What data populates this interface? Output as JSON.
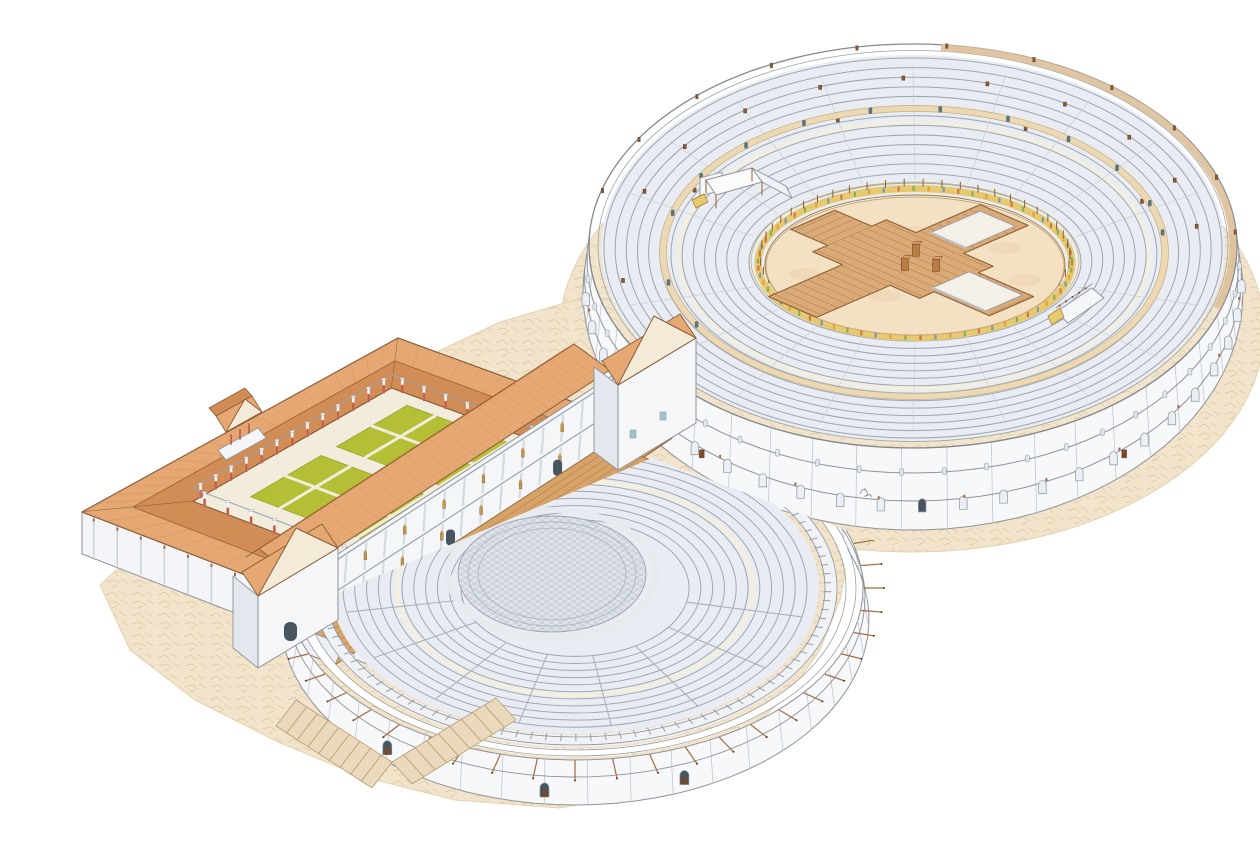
{
  "palette": {
    "bg": "#ffffff",
    "groundFill": "#f2e4cb",
    "groundCrack": "#dcc5a2",
    "groundEdge": "#e6d2b2",
    "wallWhite": "#f7f8fa",
    "wallShade": "#e2e8ee",
    "wallLine": "#8e9299",
    "jointLine": "#b9c2cb",
    "seatFill": "#e9edf3",
    "seatLine": "#9da8b4",
    "seatWalk": "#f3eee2",
    "cunei": "#c3cbd3",
    "rimTan": "#dcbf97",
    "balteus": "#ecd9b4",
    "balteusEdge": "#c4ad83",
    "doorDark": "#5a7482",
    "podiumGold": "#e7c96f",
    "podiumEdge": "#a5762e",
    "podiumOuter": "#c9b06a",
    "arenaSand": "#f4e1c4",
    "sandEdge": "#caa87b",
    "sandSpot": "#e9d2ae",
    "wood": "#d9a976",
    "woodLine": "#b9854f",
    "woodEdge": "#8a5f35",
    "stageWood": "#d7a369",
    "stageEdge": "#9c6b3b",
    "pit": "#f4f0e7",
    "pitLine": "#9aa0a8",
    "pitShade": "#b9bfc7",
    "brown": "#8a5a33",
    "brownDark": "#5f3a1e",
    "mast": "#a06a3e",
    "roofLight": "#e5a873",
    "roofMid": "#df9f68",
    "roofDark": "#d18c55",
    "roofLine": "#8a5c38",
    "roofTile": "#c98f59",
    "ridge": "#a5693c",
    "green": "#b5bf35",
    "greenLine": "#99a42b",
    "court": "#f2ecdc",
    "courtLine": "#cbbf9f",
    "orch": "#ccd3dd",
    "orchTile": "#dfe3e9",
    "orchDark": "#aab2be",
    "colRed": "#c2604c",
    "colWhite": "#f5f6f8",
    "colCap": "#e9ecf0",
    "statueGold": "#c49a52",
    "statueLine": "#7d5a26",
    "archDark": "#46555f",
    "doorBrown": "#7a4a28",
    "rampTan": "#ead9bd",
    "rampLine": "#c2a477",
    "rampEdge": "#b99d72",
    "towerWin": "#9fc3c9",
    "sig": "#8a8f96"
  },
  "scene": {
    "canvas": {
      "w": 1260,
      "h": 844
    },
    "ground": {
      "amphitheaterApron": {
        "cx": 912,
        "cy": 330,
        "rx": 352,
        "ry": 222
      },
      "theaterApron": [
        [
          100,
          585
        ],
        [
          170,
          520
        ],
        [
          240,
          468
        ],
        [
          330,
          418
        ],
        [
          420,
          360
        ],
        [
          500,
          322
        ],
        [
          575,
          300
        ],
        [
          655,
          298
        ],
        [
          702,
          324
        ],
        [
          668,
          364
        ],
        [
          700,
          404
        ],
        [
          762,
          444
        ],
        [
          822,
          494
        ],
        [
          848,
          560
        ],
        [
          840,
          600
        ],
        [
          820,
          650
        ],
        [
          792,
          690
        ],
        [
          736,
          744
        ],
        [
          660,
          790
        ],
        [
          560,
          808
        ],
        [
          455,
          800
        ],
        [
          360,
          776
        ],
        [
          278,
          742
        ],
        [
          195,
          700
        ],
        [
          130,
          650
        ]
      ]
    },
    "amphitheater": {
      "cx": 913,
      "cy": 246,
      "rx": 324,
      "ry": 202,
      "wall": {
        "drop": 46,
        "spreadX": 6,
        "spreadY": 36,
        "jointStep": 8,
        "upperWindowStep": 7.5,
        "lowerArchStep": 7.2,
        "doorAngles": [
          50,
          130
        ],
        "tickStep": 15
      },
      "rim": {
        "tanArc": [
          -85,
          18
        ],
        "mastAngles": [
          196,
          212,
          228,
          244,
          260,
          276,
          292,
          308,
          324,
          340,
          356
        ]
      },
      "bowl": {
        "rings": 14,
        "outer": [
          309,
          190
        ],
        "inner": [
          166,
          79
        ],
        "centerShift": [
          2,
          14
        ],
        "walkT": 0.52,
        "cuneiNear": [
          18,
          36,
          54,
          72,
          90,
          108,
          126,
          144,
          162
        ],
        "cuneiFar": [
          198,
          216,
          234,
          252,
          270,
          288,
          306,
          324,
          342
        ]
      },
      "balteus": {
        "cx": 914,
        "cy": 252.5,
        "rx": 251,
        "ry": 144,
        "doorAngles": [
          196,
          212,
          228,
          244,
          260,
          276,
          292,
          308,
          324,
          340,
          352,
          150,
          168
        ]
      },
      "brackets": [
        [
          0.16,
          200
        ],
        [
          0.16,
          217
        ],
        [
          0.16,
          234
        ],
        [
          0.16,
          251
        ],
        [
          0.16,
          268
        ],
        [
          0.16,
          285
        ],
        [
          0.16,
          302
        ],
        [
          0.16,
          319
        ],
        [
          0.16,
          336
        ],
        [
          0.16,
          352
        ],
        [
          0.44,
          207
        ],
        [
          0.44,
          252
        ],
        [
          0.44,
          297
        ],
        [
          0.44,
          338
        ],
        [
          0.1,
          152
        ],
        [
          0.1,
          170
        ]
      ],
      "podium": {
        "cx": 915,
        "cy": 263,
        "rx": 157,
        "ry": 74.5,
        "panelStep": 5.5,
        "postStep": 7,
        "panelColors": [
          "#cf6a45",
          "#7da854",
          "#df9f3c",
          "#6f94b5"
        ]
      },
      "arena": {
        "cx": 915,
        "cy": 266,
        "rx": 149,
        "ry": 69,
        "spots": [
          [
            -70,
            -10
          ],
          [
            40,
            22
          ],
          [
            90,
            -18
          ],
          [
            -30,
            30
          ],
          [
            0,
            -34
          ],
          [
            110,
            14
          ],
          [
            -110,
            8
          ]
        ]
      },
      "platform": {
        "m": [
          903,
          259
        ],
        "halfU": 58,
        "halfV": 40,
        "armU": 118,
        "armUneg": 98,
        "armVpos": 110,
        "armVneg": 120,
        "armHalfU": 26,
        "armHalfV": 24,
        "pits": [
          [
            52,
            -20,
            110,
            20
          ],
          [
            -18,
            48,
            20,
            102
          ]
        ],
        "boxes": [
          [
            8,
            -6
          ],
          [
            26,
            10
          ],
          [
            -4,
            18
          ]
        ]
      },
      "tribunal": {
        "canopy": [
          [
            706,
            180
          ],
          [
            752,
            168
          ],
          [
            762,
            182
          ],
          [
            716,
            195
          ]
        ],
        "wall": [
          [
            700,
            196
          ],
          [
            722,
            190
          ],
          [
            722,
            172
          ],
          [
            700,
            178
          ]
        ],
        "arch": [
          722,
          176,
          10,
          15
        ],
        "wing": [
          [
            752,
            168
          ],
          [
            786,
            186
          ],
          [
            792,
            198
          ],
          [
            762,
            182
          ]
        ],
        "gold": [
          [
            692,
            200
          ],
          [
            704,
            194
          ],
          [
            708,
            202
          ],
          [
            696,
            208
          ]
        ]
      },
      "ramp": {
        "floor": [
          [
            1056,
            312
          ],
          [
            1092,
            288
          ],
          [
            1104,
            298
          ],
          [
            1068,
            323
          ]
        ],
        "rail": [
          [
            1056,
            308
          ],
          [
            1092,
            284
          ]
        ],
        "gold": [
          [
            1048,
            316
          ],
          [
            1060,
            308
          ],
          [
            1064,
            317
          ],
          [
            1052,
            325
          ]
        ]
      }
    },
    "portico": {
      "corners": {
        "W": [
          82,
          512
        ],
        "N": [
          398,
          338
        ],
        "E": [
          672,
          438
        ],
        "S": [
          388,
          630
        ]
      },
      "courtyard": {
        "a0": 0.18,
        "a1": 0.82,
        "b0": 0.18,
        "b1": 0.8
      },
      "gardens": [
        {
          "a": [
            0.27,
            0.5
          ],
          "b": [
            0.28,
            0.48
          ]
        },
        {
          "a": [
            0.55,
            0.78
          ],
          "b": [
            0.28,
            0.48
          ]
        },
        {
          "a": [
            0.27,
            0.5
          ],
          "b": [
            0.54,
            0.74
          ]
        },
        {
          "a": [
            0.55,
            0.78
          ],
          "b": [
            0.54,
            0.74
          ]
        }
      ],
      "ornaments": {
        "statue": [
          0.52,
          0.51
        ],
        "figure": [
          0.42,
          0.55
        ],
        "bench": [
          0.47,
          0.58
        ]
      },
      "wallDrop": 42,
      "pilasters": 13,
      "ridgeF": 0.46,
      "colCounts": {
        "long": 13,
        "short": 8
      },
      "aedicula": {
        "base": [
          [
            218,
            450
          ],
          [
            258,
            428
          ],
          [
            266,
            438
          ],
          [
            226,
            460
          ]
        ],
        "ped": [
          [
            226,
            432
          ],
          [
            262,
            412
          ],
          [
            245,
            399
          ]
        ],
        "roofA": [
          [
            226,
            432
          ],
          [
            262,
            412
          ],
          [
            252,
            396
          ],
          [
            216,
            416
          ]
        ],
        "roofB": [
          [
            216,
            416
          ],
          [
            252,
            396
          ],
          [
            245,
            388
          ],
          [
            209,
            408
          ]
        ],
        "cols": [
          [
            231,
            444
          ],
          [
            240,
            439
          ],
          [
            249,
            433
          ]
        ]
      }
    },
    "theater": {
      "o": [
        575,
        588
      ],
      "k": 0.6,
      "clip": [
        [
          310,
          605
        ],
        [
          652,
          458
        ],
        [
          980,
          580
        ],
        [
          980,
          852
        ],
        [
          60,
          852
        ],
        [
          60,
          700
        ],
        [
          240,
          620
        ]
      ],
      "stage": {
        "f1": [
          335,
          665
        ],
        "f2": [
          650,
          460
        ],
        "depth": [
          -42,
          -17
        ],
        "teethStep": 0.068,
        "nLength": 5,
        "nTicks": 22
      },
      "frons": {
        "rise": [
          5,
          -68
        ],
        "cornices": [
          0.44,
          0.92
        ],
        "tiers": [
          [
            0.05,
            0.4
          ],
          [
            0.5,
            0.88
          ]
        ],
        "cols": 16,
        "doors": [
          0.16,
          0.5,
          0.84
        ]
      },
      "roof": {
        "eaveOff": [
          -3,
          -5
        ],
        "depthOff": [
          -36,
          -26
        ],
        "stripOff": [
          -13,
          8
        ],
        "tiles": 26
      },
      "wall": {
        "rx": 288,
        "ry": 172,
        "drop": 31,
        "spreadX": 6,
        "spreadY": 14,
        "jointStep": 8.5,
        "a0": -45,
        "a1": 198,
        "doorAngles": [
          68,
          96,
          130
        ],
        "mastStep": 7.5,
        "mastLen": 20
      },
      "parapet": {
        "rx": 276,
        "ry": 165
      },
      "gallery": {
        "rx": 256,
        "ry": 153,
        "colStep": 3.4,
        "a0": -70,
        "a1": 196
      },
      "seating": {
        "outer": [
          244,
          146
        ],
        "rings": 11,
        "r0": 232,
        "dr": 11.8,
        "walk": 178,
        "stairs": [
          12,
          35,
          58,
          81,
          104,
          127,
          150,
          170
        ],
        "inner": 114
      },
      "orchestra": {
        "c": [
          552,
          574
        ],
        "rx": 94,
        "ry": 58,
        "rings": [
          84,
          74
        ],
        "proedria": [
          104,
          64
        ]
      },
      "towerLeft": {
        "front": [
          [
            258,
            668
          ],
          [
            338,
            620
          ],
          [
            338,
            548
          ],
          [
            258,
            596
          ]
        ],
        "side": [
          [
            233,
            648
          ],
          [
            258,
            668
          ],
          [
            258,
            596
          ],
          [
            233,
            576
          ]
        ],
        "ped": [
          [
            258,
            596
          ],
          [
            338,
            548
          ],
          [
            296,
            528
          ]
        ],
        "roof": [
          [
            258,
            596
          ],
          [
            338,
            548
          ],
          [
            322,
            524
          ],
          [
            242,
            572
          ]
        ],
        "door": [
          284,
          622,
          13,
          19
        ]
      },
      "towerRight": {
        "front": [
          [
            618,
            470
          ],
          [
            696,
            423
          ],
          [
            696,
            338
          ],
          [
            618,
            385
          ]
        ],
        "side": [
          [
            594,
            452
          ],
          [
            618,
            470
          ],
          [
            618,
            385
          ],
          [
            594,
            367
          ]
        ],
        "ped": [
          [
            618,
            385
          ],
          [
            696,
            338
          ],
          [
            654,
            316
          ]
        ],
        "roof": [
          [
            618,
            385
          ],
          [
            696,
            338
          ],
          [
            680,
            314
          ],
          [
            602,
            361
          ]
        ],
        "windows": [
          [
            630,
            430
          ],
          [
            660,
            412
          ]
        ]
      },
      "aditus": [
        [
          335,
          665
        ],
        [
          293,
          648
        ],
        [
          301,
          628
        ],
        [
          343,
          645
        ]
      ],
      "ramps": [
        [
          [
            296,
            700
          ],
          [
            392,
            762
          ],
          [
            372,
            788
          ],
          [
            276,
            726
          ]
        ],
        [
          [
            392,
            762
          ],
          [
            496,
            698
          ],
          [
            516,
            720
          ],
          [
            412,
            784
          ]
        ]
      ],
      "rampSteps": 9
    },
    "signature": {
      "x": 864,
      "y": 490
    }
  }
}
